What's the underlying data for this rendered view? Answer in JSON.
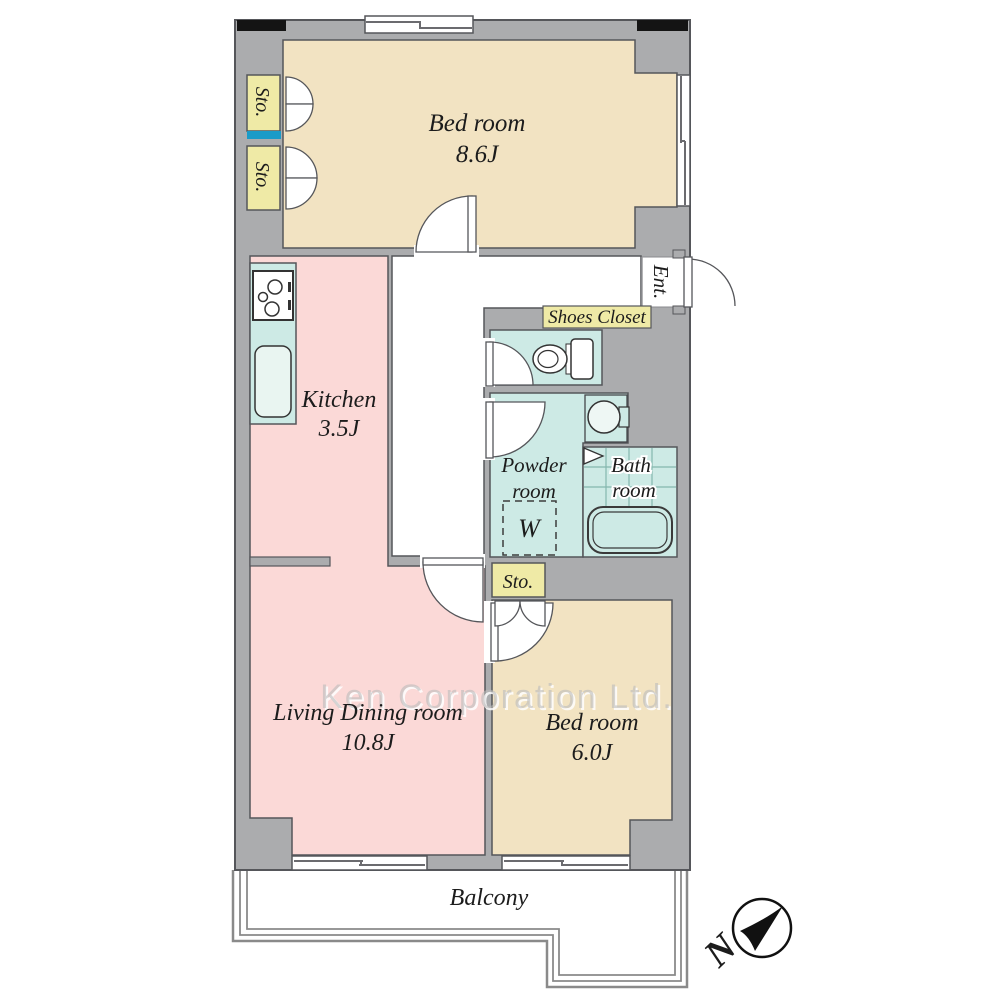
{
  "rooms": {
    "bedroom1": {
      "name": "Bed room",
      "size": "8.6J"
    },
    "kitchen": {
      "name": "Kitchen",
      "size": "3.5J"
    },
    "living": {
      "name": "Living Dining room",
      "size": "10.8J"
    },
    "bedroom2": {
      "name": "Bed room",
      "size": "6.0J"
    },
    "powder": {
      "name_line1": "Powder",
      "name_line2": "room",
      "washer_label": "W"
    },
    "bath": {
      "name_line1": "Bath",
      "name_line2": "room"
    }
  },
  "closets": {
    "storage1": "Sto.",
    "storage2": "Sto.",
    "storage3": "Sto.",
    "shoes_closet": "Shoes Closet"
  },
  "entrance_label": "Ent.",
  "balcony_label": "Balcony",
  "compass": {
    "north": "N"
  },
  "watermark": "Ken Corporation Ltd.",
  "colors": {
    "wall_gray": "#abacae",
    "outline": "#55565a",
    "bedroom_tan": "#f2e3c2",
    "living_pink": "#fbd9d7",
    "closet_yellow": "#efeaa6",
    "wet_area_teal": "#cdeae5",
    "shelf_blue": "#1a9bc8",
    "pillar_black": "#141414",
    "watermark_gray": "#bcbcbc"
  },
  "icons": {
    "compass_needle": "north-arrow",
    "bifold_marker": "bath-folding-door",
    "stove": "gas-stove",
    "sink": "kitchen-sink",
    "toilet": "toilet",
    "basin": "wash-basin",
    "washer": "washing-machine-space",
    "bathtub": "bathtub"
  }
}
